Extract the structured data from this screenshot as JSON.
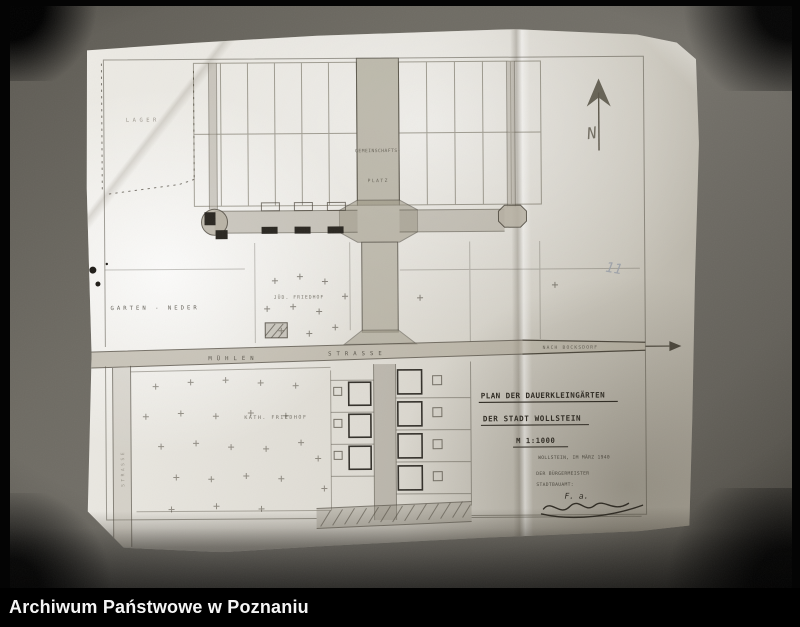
{
  "footer": {
    "archive_name": "Archiwum Państwowe w Poznaniu"
  },
  "photo": {
    "page_number_annotation": "11"
  },
  "compass": {
    "north_letter": "N"
  },
  "plan": {
    "labels": {
      "lager": "LAGER",
      "gemeinschafts_line1": "GEMEINSCHAFTS-",
      "gemeinschafts_line2": "PLATZ",
      "garten_neder": "GARTEN - NEDER",
      "jued_friedhof": "JÜD. FRIEDHOF",
      "muehlen": "MÜHLEN",
      "strasse": "STRASSE",
      "nach_bocksdorf": "NACH BOCKSDORF",
      "kath_friedhof": "KATH. FRIEDHOF",
      "side_street": "STRASSE"
    },
    "title_block": {
      "line1": "PLAN DER DAUERKLEINGÄRTEN",
      "line2": "DER STADT WOLLSTEIN",
      "scale": "M 1:1000",
      "place_date": "WOLLSTEIN, IM MÄRZ 1940",
      "issuer_line1": "DER BÜRGERMEISTER",
      "issuer_line2": "STADTBAUAMT:",
      "signature_initials": "F. a."
    }
  },
  "colors": {
    "footer_bg": "#000000",
    "footer_text": "#f5f5f5",
    "photo_background": "#6b6860",
    "paper": "#e7e5de",
    "ink": "#4a453a",
    "pencil": "#9ba0a8"
  }
}
